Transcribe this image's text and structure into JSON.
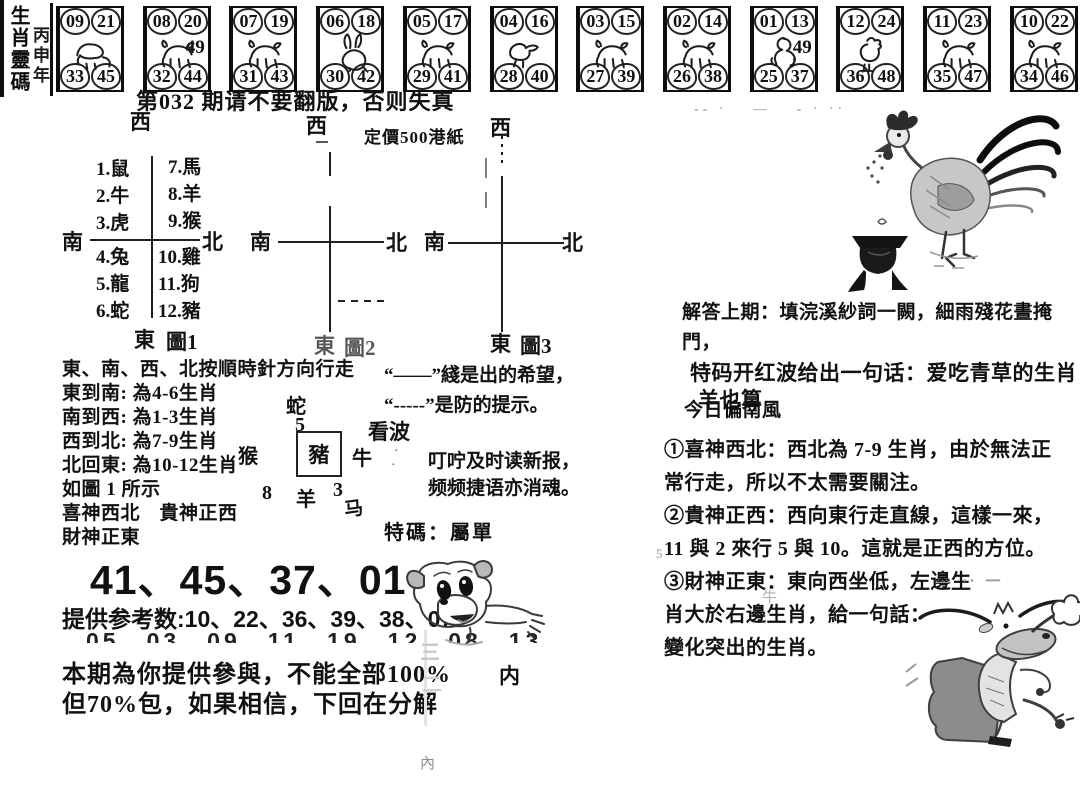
{
  "masthead": {
    "title": "生肖靈碼",
    "year": "丙申年"
  },
  "zodiac_strip": {
    "boxes": [
      {
        "animal": "鼠",
        "tl": "09",
        "tr": "21",
        "bl": "33",
        "br": "45",
        "extra": ""
      },
      {
        "animal": "牛",
        "tl": "08",
        "tr": "20",
        "bl": "32",
        "br": "44",
        "extra": "49"
      },
      {
        "animal": "虎",
        "tl": "07",
        "tr": "19",
        "bl": "31",
        "br": "43",
        "extra": ""
      },
      {
        "animal": "兔",
        "tl": "06",
        "tr": "18",
        "bl": "30",
        "br": "42",
        "extra": ""
      },
      {
        "animal": "龍",
        "tl": "05",
        "tr": "17",
        "bl": "29",
        "br": "41",
        "extra": ""
      },
      {
        "animal": "蛇",
        "tl": "04",
        "tr": "16",
        "bl": "28",
        "br": "40",
        "extra": ""
      },
      {
        "animal": "馬",
        "tl": "03",
        "tr": "15",
        "bl": "27",
        "br": "39",
        "extra": ""
      },
      {
        "animal": "羊",
        "tl": "02",
        "tr": "14",
        "bl": "26",
        "br": "38",
        "extra": ""
      },
      {
        "animal": "猴",
        "tl": "01",
        "tr": "13",
        "bl": "25",
        "br": "37",
        "extra": "49"
      },
      {
        "animal": "雞",
        "tl": "12",
        "tr": "24",
        "bl": "36",
        "br": "48",
        "extra": ""
      },
      {
        "animal": "狗",
        "tl": "11",
        "tr": "23",
        "bl": "35",
        "br": "47",
        "extra": ""
      },
      {
        "animal": "豬",
        "tl": "10",
        "tr": "22",
        "bl": "34",
        "br": "46",
        "extra": ""
      }
    ]
  },
  "notice": "第032 期请不要翻版，否则失真",
  "price": "定價500港紙",
  "zodiac_table": {
    "q_tl": [
      "1.鼠",
      "2.牛",
      "3.虎"
    ],
    "q_tr": [
      "7.馬",
      "8.羊",
      "9.猴"
    ],
    "q_bl": [
      "4.兔",
      "5.龍",
      "6.蛇"
    ],
    "q_br": [
      "10.雞",
      "11.狗",
      "12.豬"
    ]
  },
  "diagrams": {
    "d1": {
      "west": "西",
      "south": "南",
      "north": "北",
      "east": "東",
      "caption": "圖1"
    },
    "d2": {
      "west": "西",
      "south": "南",
      "north": "北",
      "east": "東",
      "caption": "圖2"
    },
    "d3": {
      "west": "西",
      "south": "南",
      "north": "北",
      "east": "東",
      "caption": "圖3"
    }
  },
  "instructions": {
    "lines": [
      "東、南、西、北按順時針方向行走",
      "東到南: 為4-6生肖",
      "南到西: 為1-3生肖",
      "西到北: 為7-9生肖",
      "北回東: 為10-12生肖",
      "如圖 1 所示",
      "喜神西北　貴神正西",
      "財神正東"
    ]
  },
  "mini_cross": {
    "top": "蛇",
    "top_num": "5",
    "left": "猴",
    "center": "豬",
    "right": "牛",
    "num8": "8",
    "bottom": "羊",
    "num3": "3",
    "horse": "马",
    "note": "看波"
  },
  "quotes": {
    "line1": "“——”綫是出的希望，",
    "line2": "“-----”是防的提示。",
    "line3": "叮咛及时读新报，",
    "line4": "频频捷语亦消魂。",
    "special": "特碼：屬單"
  },
  "answers": {
    "lines": [
      "解答上期：填浣溪紗詞一闕，細雨殘花晝掩門，",
      "特码开红波给出一句话：爱吃青草的生肖",
      "羊也算",
      "今日偏南風",
      "①喜神西北：西北為 7-9 生肖，由於無法正",
      "常行走，所以不太需要關注。",
      "②貴神正西：西向東行走直線，這樣一來，",
      "11 與 2 來行 5 與 10。這就是正西的方位。",
      "③財神正東：東向西坐低，左邊生",
      "肖大於右邊生肖，給一句話：",
      "變化突出的生肖。"
    ]
  },
  "picks": {
    "main": "41、45、37、01",
    "ref1": "提供参考数:10、22、36、39、38、07",
    "ref2": "05、03、09、11、19、12、08、13",
    "note1": "本期為你提供參與，不能全部100%",
    "note1_side": "内",
    "note2": "但70%包，如果相信，下回在分解"
  },
  "faint_marks": {
    "top_dashes": "-- ·　 —　 - · ··",
    "mid_dashes": "— ‥ 一",
    "bleed1": "三",
    "bleed2": "二",
    "bleed3": "內",
    "bleed_cow": "牛",
    "bleed_5": "5",
    "dot1": "·",
    "dot2": "·"
  }
}
